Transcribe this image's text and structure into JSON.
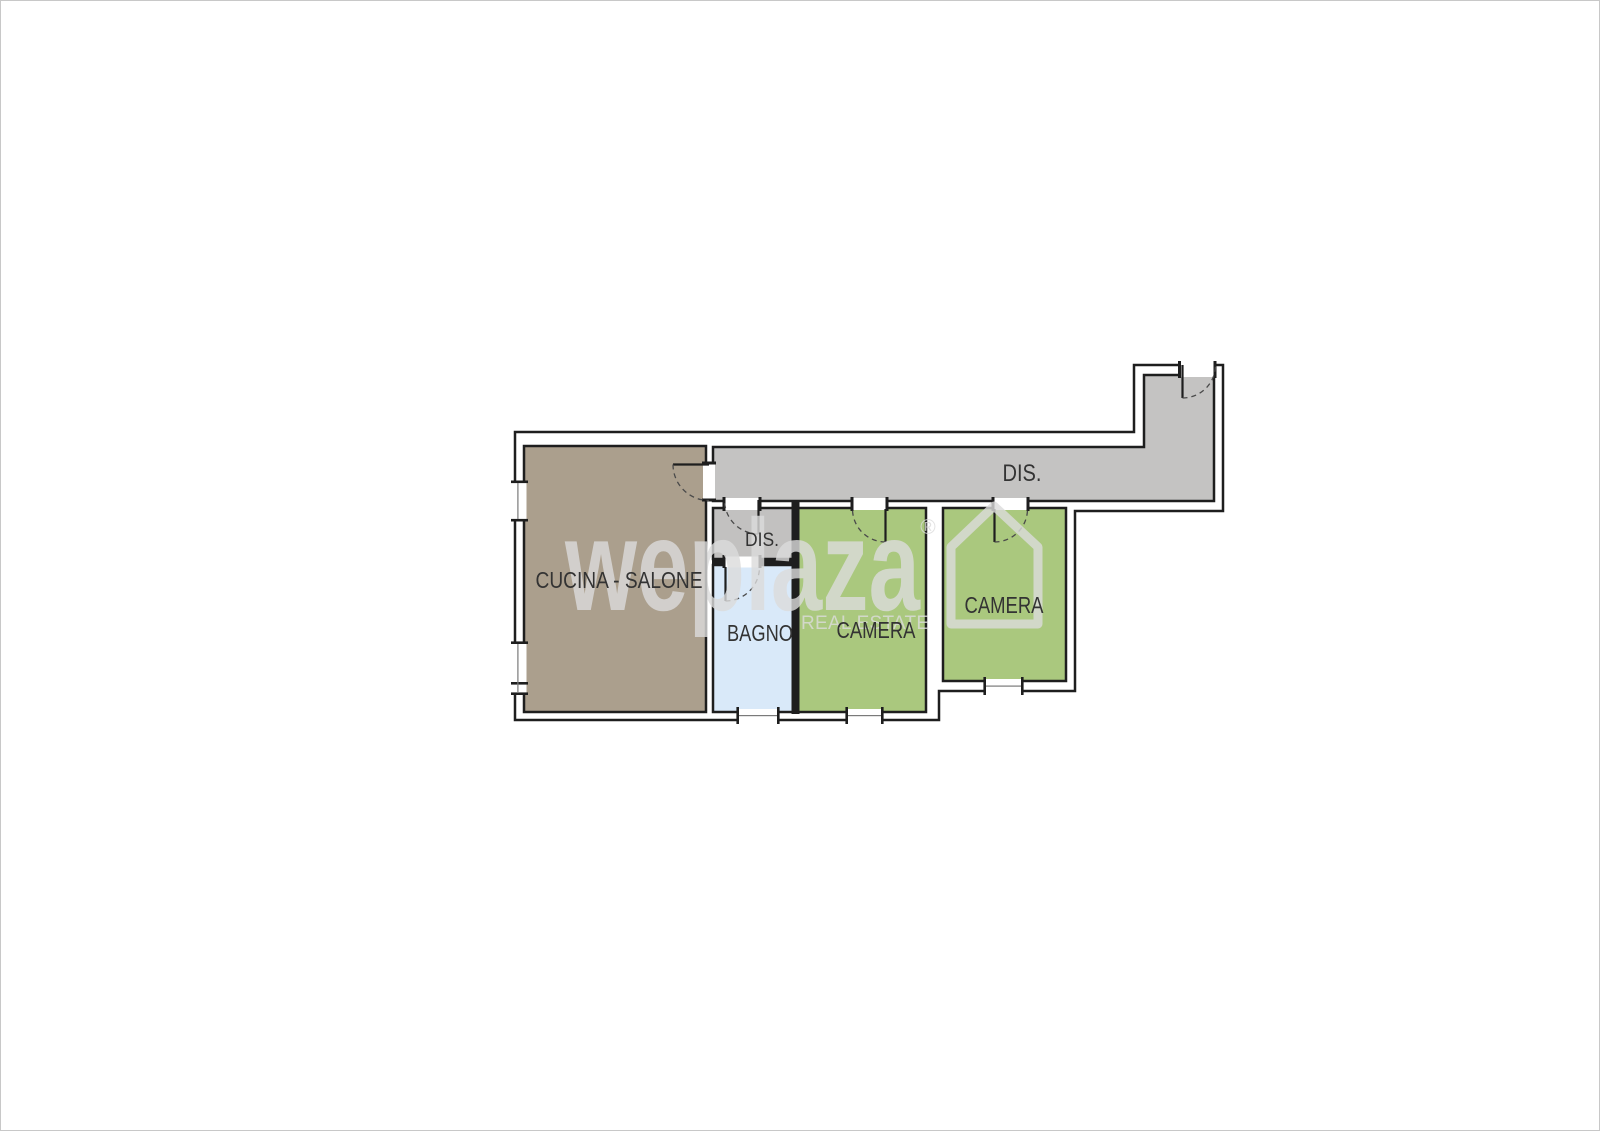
{
  "canvas": {
    "background": "#ffffff",
    "border_color": "#c8c8c8"
  },
  "plan": {
    "wall_color": "#1e1e1e",
    "rooms": {
      "cucina": {
        "label": "CUCINA - SALONE",
        "color": "#ab9f8d"
      },
      "corridoio": {
        "label": "DIS.",
        "color": "#c4c3c2"
      },
      "disimpegno": {
        "label": "DIS.",
        "color": "#c2c1c0"
      },
      "bagno": {
        "label": "BAGNO",
        "color": "#d9e9f9"
      },
      "camera1": {
        "label": "CAMERA",
        "color": "#aac87e"
      },
      "camera2": {
        "label": "CAMERA",
        "color": "#aac87e"
      }
    }
  },
  "watermark": {
    "brand": "weplaza",
    "registered_mark": "®",
    "tagline": "REAL ESTATE",
    "color": "#dcdcdc"
  }
}
